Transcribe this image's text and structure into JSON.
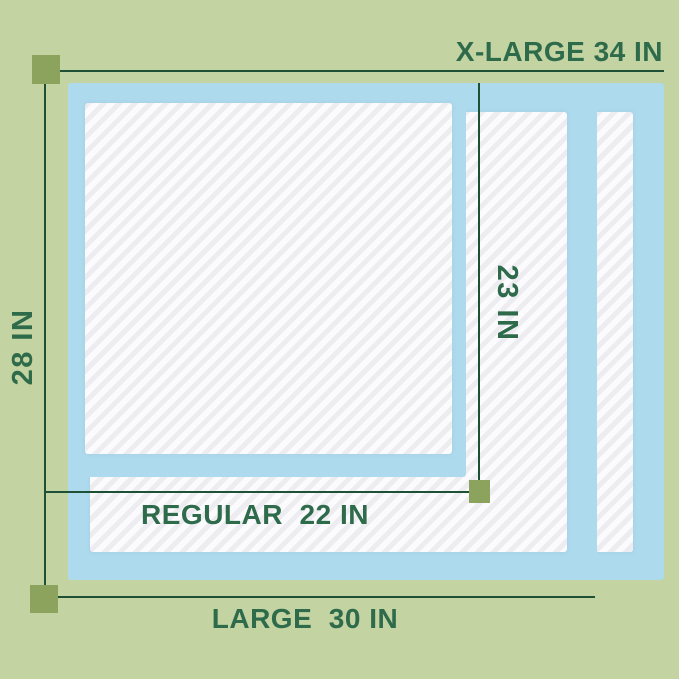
{
  "colors": {
    "bg": "#c3d3a1",
    "pad-blue": "#aedaee",
    "line": "#1d5034",
    "marker": "#8ca35e",
    "text": "#2e6b4b",
    "stripe-a": "#ececf1",
    "stripe-b": "#fbfbfd"
  },
  "annotations": {
    "top": {
      "label": "X-LARGE 34 IN",
      "value_in": 34
    },
    "left": {
      "label": "28 IN",
      "value_in": 28
    },
    "inner_vertical": {
      "label": "23 IN",
      "value_in": 23
    },
    "inner_horizontal": {
      "label": "REGULAR  22 IN",
      "value_in": 22
    },
    "bottom": {
      "label": "LARGE  30 IN",
      "value_in": 30
    }
  },
  "pads": [
    {
      "name": "X-Large pad",
      "width_in": 34,
      "height_in": 28
    },
    {
      "name": "Large pad",
      "width_in": 30
    },
    {
      "name": "Regular pad",
      "width_in": 22,
      "height_in": 23
    }
  ]
}
